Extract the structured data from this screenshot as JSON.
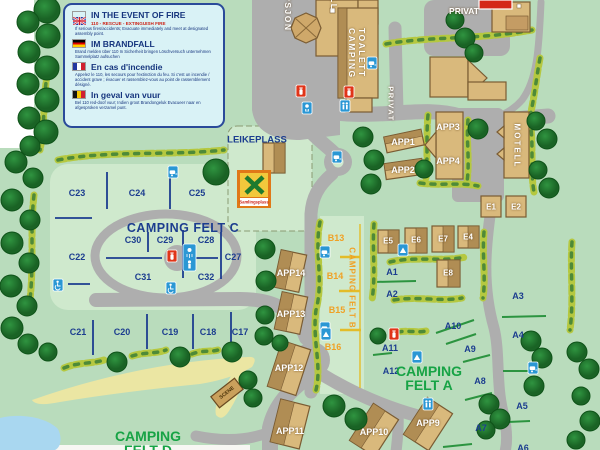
{
  "legend": {
    "en": {
      "title": "IN THE EVENT OF FIRE",
      "phone": "110 - RESCUE - EXTINGUISH FIRE",
      "body": "If serious fires/accidents; Evacuate immediately and meet at designated assembly point."
    },
    "de": {
      "title": "IM  BRANDFALL",
      "body": "Brand melden über 110 In Sicherheit bringen Löschversuch unternehmen Sammelplatz aufsuchen"
    },
    "fr": {
      "title": "En cas d'incendie",
      "body": "Appelez le 110, les secours pour l'extinction du feu. Si c'est un incendie / accident grave ; évacuer et rassemblez-vous au point de rassemblement désigné."
    },
    "nl": {
      "title": "In geval van vuur",
      "body": "Bel 110 red-doof vuur; Indien groot Brandongeluk Evacueer naar en afgesproken verzamel punt."
    }
  },
  "titles": {
    "felt_c": "CAMPING FELT C",
    "felt_b": "CAMPING FELT B",
    "felt_a_1": "CAMPING",
    "felt_a_2": "FELT A",
    "felt_d_1": "CAMPING",
    "felt_d_2": "FELT D"
  },
  "places": {
    "leikeplass": "LEIKEPLASS",
    "samlingsplass": "Samlingsplass",
    "scene": "SCENE",
    "resepsjon": "RESEPSJON",
    "toalett_1": "TOALETT",
    "toalett_2": "CAMPING",
    "motell": "MOTELL",
    "privat_top": "PRIVAT",
    "privat_road": "PRIVAT",
    "partial_top": "LL"
  },
  "labels": {
    "c17": "C17",
    "c18": "C18",
    "c19": "C19",
    "c20": "C20",
    "c21": "C21",
    "c22": "C22",
    "c23": "C23",
    "c24": "C24",
    "c25": "C25",
    "c27": "C27",
    "c28": "C28",
    "c29": "C29",
    "c30": "C30",
    "c31": "C31",
    "c32": "C32",
    "b13": "B13",
    "b14": "B14",
    "b15": "B15",
    "b16": "B16",
    "a1": "A1",
    "a2": "A2",
    "a3": "A3",
    "a4": "A4",
    "a5": "A5",
    "a6": "A6",
    "a7": "A7",
    "a8": "A8",
    "a9": "A9",
    "a10": "A10",
    "a11": "A11",
    "a12": "A12",
    "e1": "E1",
    "e2": "E2",
    "e4": "E4",
    "e5": "E5",
    "e6": "E6",
    "e7": "E7",
    "e8": "E8",
    "app1": "APP1",
    "app2": "APP2",
    "app3": "APP3",
    "app4": "APP4",
    "app9": "APP9",
    "app10": "APP10",
    "app11": "APP11",
    "app12": "APP12",
    "app13": "APP13",
    "app14": "APP14"
  },
  "icons": {
    "caravan": "blue square with white caravan glyph",
    "tent": "blue square with white tent glyph",
    "toilet": "blue square with two white figures",
    "shower": "blue square with white shower head",
    "wheelchair": "blue square with white wheelchair",
    "fire_extinguisher": "red square with white extinguisher",
    "assembly_point": "yellow sign with green cross (Samlingsplass)"
  },
  "colors": {
    "map_green": "#b9dcbc",
    "light_green": "#cfe9cd",
    "road_gray": "#aeaeae",
    "tree_green": "#1f7a2c",
    "building_tan": "#d9b97c",
    "building_brown": "#b08d54",
    "navy_text": "#1c3d8f",
    "orange_text": "#f0a125",
    "green_text": "#17a345",
    "icon_blue": "#2a97d4",
    "icon_red": "#e03418",
    "water_blue": "#a9d7f0",
    "sand": "#ebe6a3",
    "legend_bg": "#d9f2f6",
    "legend_border": "#2a4a9a"
  }
}
